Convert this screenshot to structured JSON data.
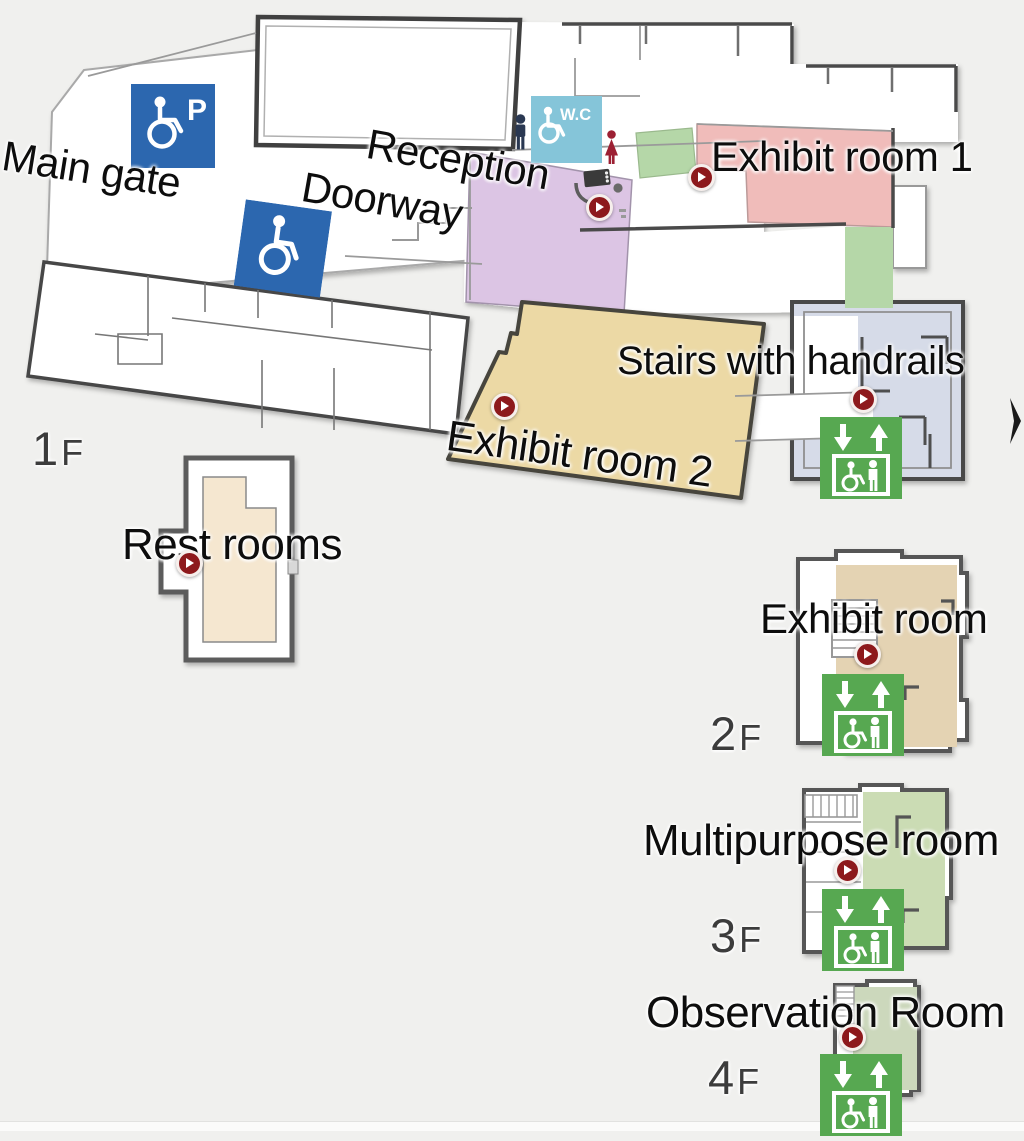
{
  "page": {
    "width": 1024,
    "height": 1130,
    "background": "#f0f0ee"
  },
  "map": {
    "floor_labels": [
      {
        "number": "1",
        "suffix": "F"
      },
      {
        "number": "2",
        "suffix": "F"
      },
      {
        "number": "3",
        "suffix": "F"
      },
      {
        "number": "4",
        "suffix": "F"
      }
    ],
    "labels": {
      "main_gate": "Main gate",
      "doorway": "Doorway",
      "reception": "Reception",
      "exhibit_room_1": "Exhibit room 1",
      "exhibit_room_2": "Exhibit room 2",
      "stairs_with_handrails": "Stairs with handrails",
      "rest_rooms": "Rest rooms",
      "exhibit_room_2f": "Exhibit room",
      "multipurpose_room_3f": "Multipurpose room",
      "observation_room_4f": "Observation Room"
    },
    "signs": {
      "wc": "W.C",
      "parking": "P"
    },
    "icons": [
      "accessible-parking-icon",
      "wheelchair-icon",
      "wc-icon",
      "men-icon",
      "women-icon",
      "video-camera-icon",
      "elevator-icon",
      "play-marker-icon",
      "arrow-icon"
    ],
    "markers": {
      "count": 8,
      "locations": [
        "reception",
        "exhibit-room-1",
        "exhibit-room-2",
        "stairs-1f",
        "rest-rooms",
        "exhibit-room-2f",
        "multipurpose-room-3f",
        "observation-room-4f"
      ]
    },
    "colors": {
      "background": "#f0f0ee",
      "wall_dark": "#4a4a4a",
      "wall_light": "#9a9a9a",
      "room_pink": "#f0bcba",
      "room_green": "#b5d7a8",
      "room_purple": "#dcc5e4",
      "room_tan": "#ecd9a5",
      "room_stairs_blue": "#d6dbe8",
      "room_beige": "#f5e7d0",
      "room_tan_2f": "#e4d3b3",
      "room_green_3f": "#cbdcb4",
      "room_green_4f": "#ccd8bc",
      "icon_blue": "#2c67af",
      "icon_cyan": "#85c5d9",
      "elevator_green": "#57a851",
      "marker_red": "#8d191c",
      "men_navy": "#2a3852",
      "women_red": "#9c2033"
    }
  }
}
